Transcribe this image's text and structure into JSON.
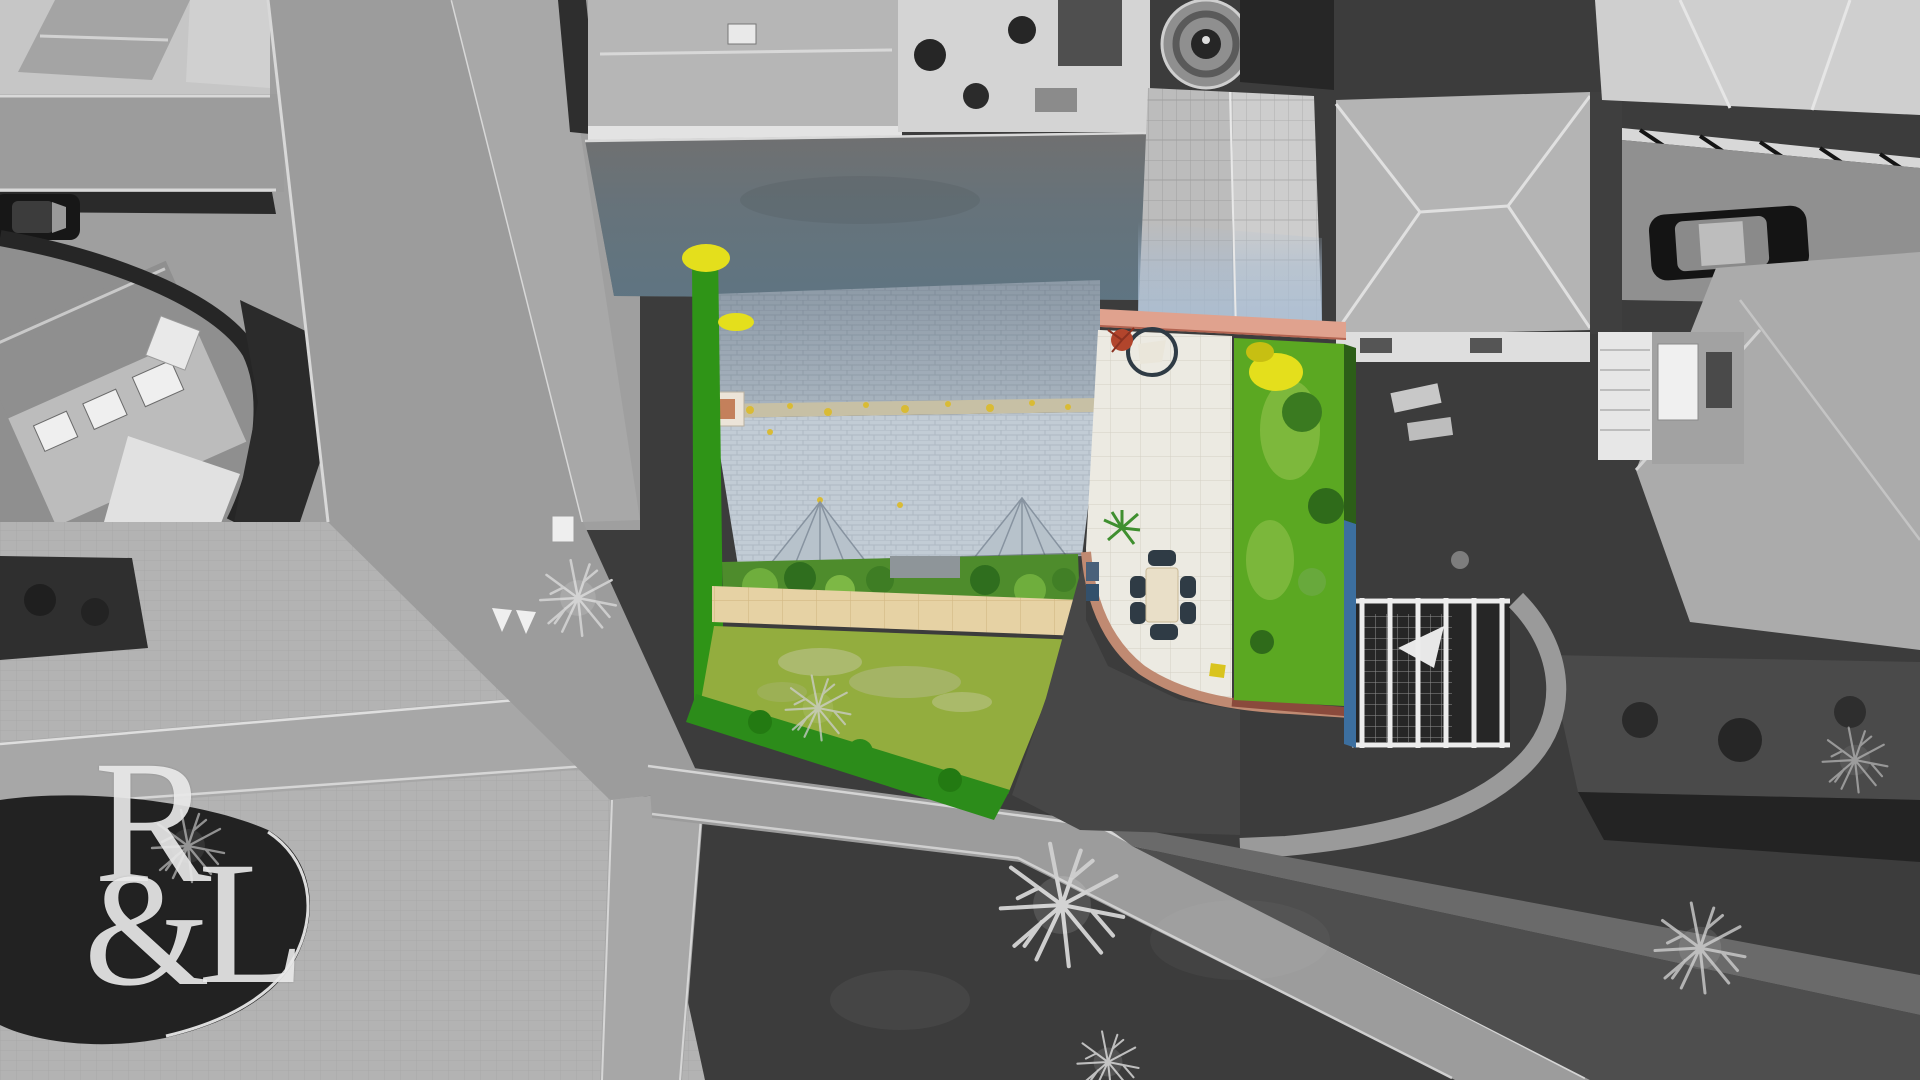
{
  "watermark": {
    "letter_r": "R",
    "ampersand": "&",
    "letter_l": "L",
    "color": "#ebebeb"
  },
  "palette": {
    "mono_road": "#9c9c9c",
    "mono_paving_light": "#c6c6c6",
    "mono_brick_road": "#b3b3b3",
    "mono_path": "#a7a7a7",
    "mono_dark_hedge": "#222222",
    "mono_field": "#3c3c3c",
    "roof_slate_lower": "#c2ccd5",
    "roof_ridge": "#c7c0a5",
    "hedge_green": "#2f9417",
    "bottom_hedge_green": "#2c8c1a",
    "lawn_front": "#93ad3e",
    "lawn_rear": "#5ba822",
    "shrub_green": "#4e8c2c",
    "flower_yellow": "#e4df1c",
    "path_stone": "#e6d2a4",
    "patio_paving": "#eceae2",
    "patio_brick_edge": "#c08a72",
    "wall_salmon": "#e0a28e",
    "wall_maroon": "#8a4a3c",
    "drive_tint": "#5e7583",
    "garage_roof_tint": "#a9bdd3",
    "fence_blue": "#3c6f9f",
    "plant_red": "#b2452c",
    "table_cream": "#e9dfc8",
    "chair_dark": "#2f3b45"
  }
}
